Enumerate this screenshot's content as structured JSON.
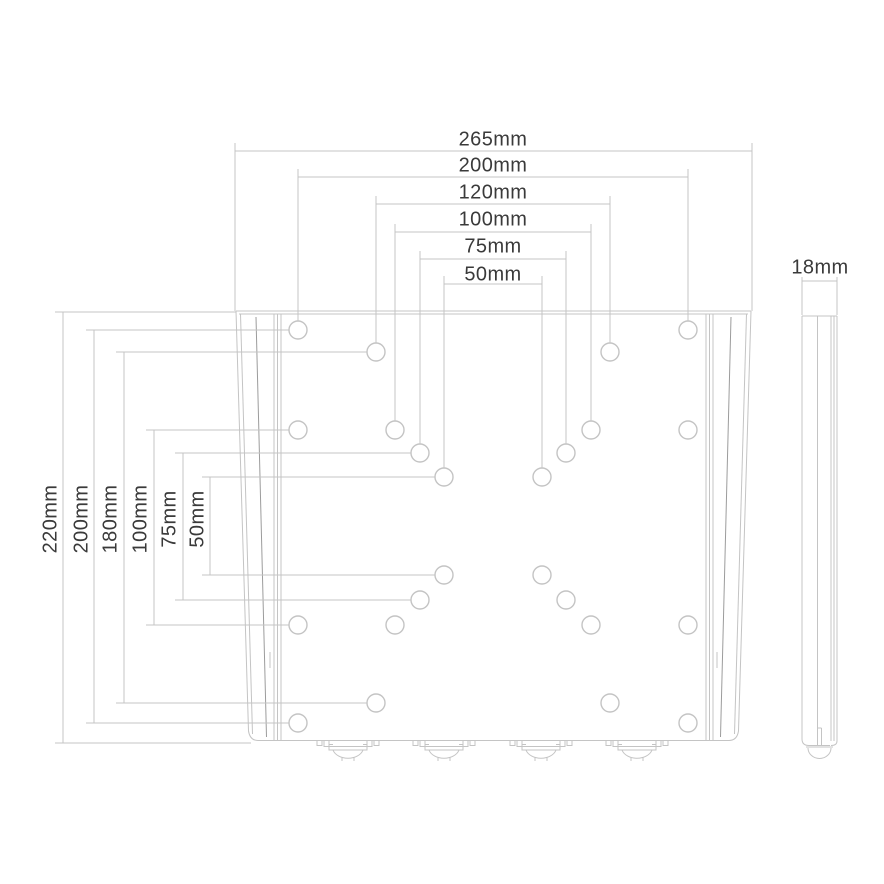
{
  "drawing": {
    "description": "Dimensioned technical line drawing of a flat wall-mount plate: front view with mounting holes and bottom screw tabs, plus a thin side profile view"
  },
  "front_view": {
    "dimensions_horizontal": [
      "265mm",
      "200mm",
      "120mm",
      "100mm",
      "75mm",
      "50mm"
    ],
    "dimensions_vertical": [
      "220mm",
      "200mm",
      "180mm",
      "100mm",
      "75mm",
      "50mm"
    ]
  },
  "side_view": {
    "dimension_thickness": "18mm"
  },
  "colors": {
    "line": "#c4c4c4",
    "line_dark": "#9c9c9c",
    "text": "#3a3a3a",
    "background": "#ffffff"
  }
}
